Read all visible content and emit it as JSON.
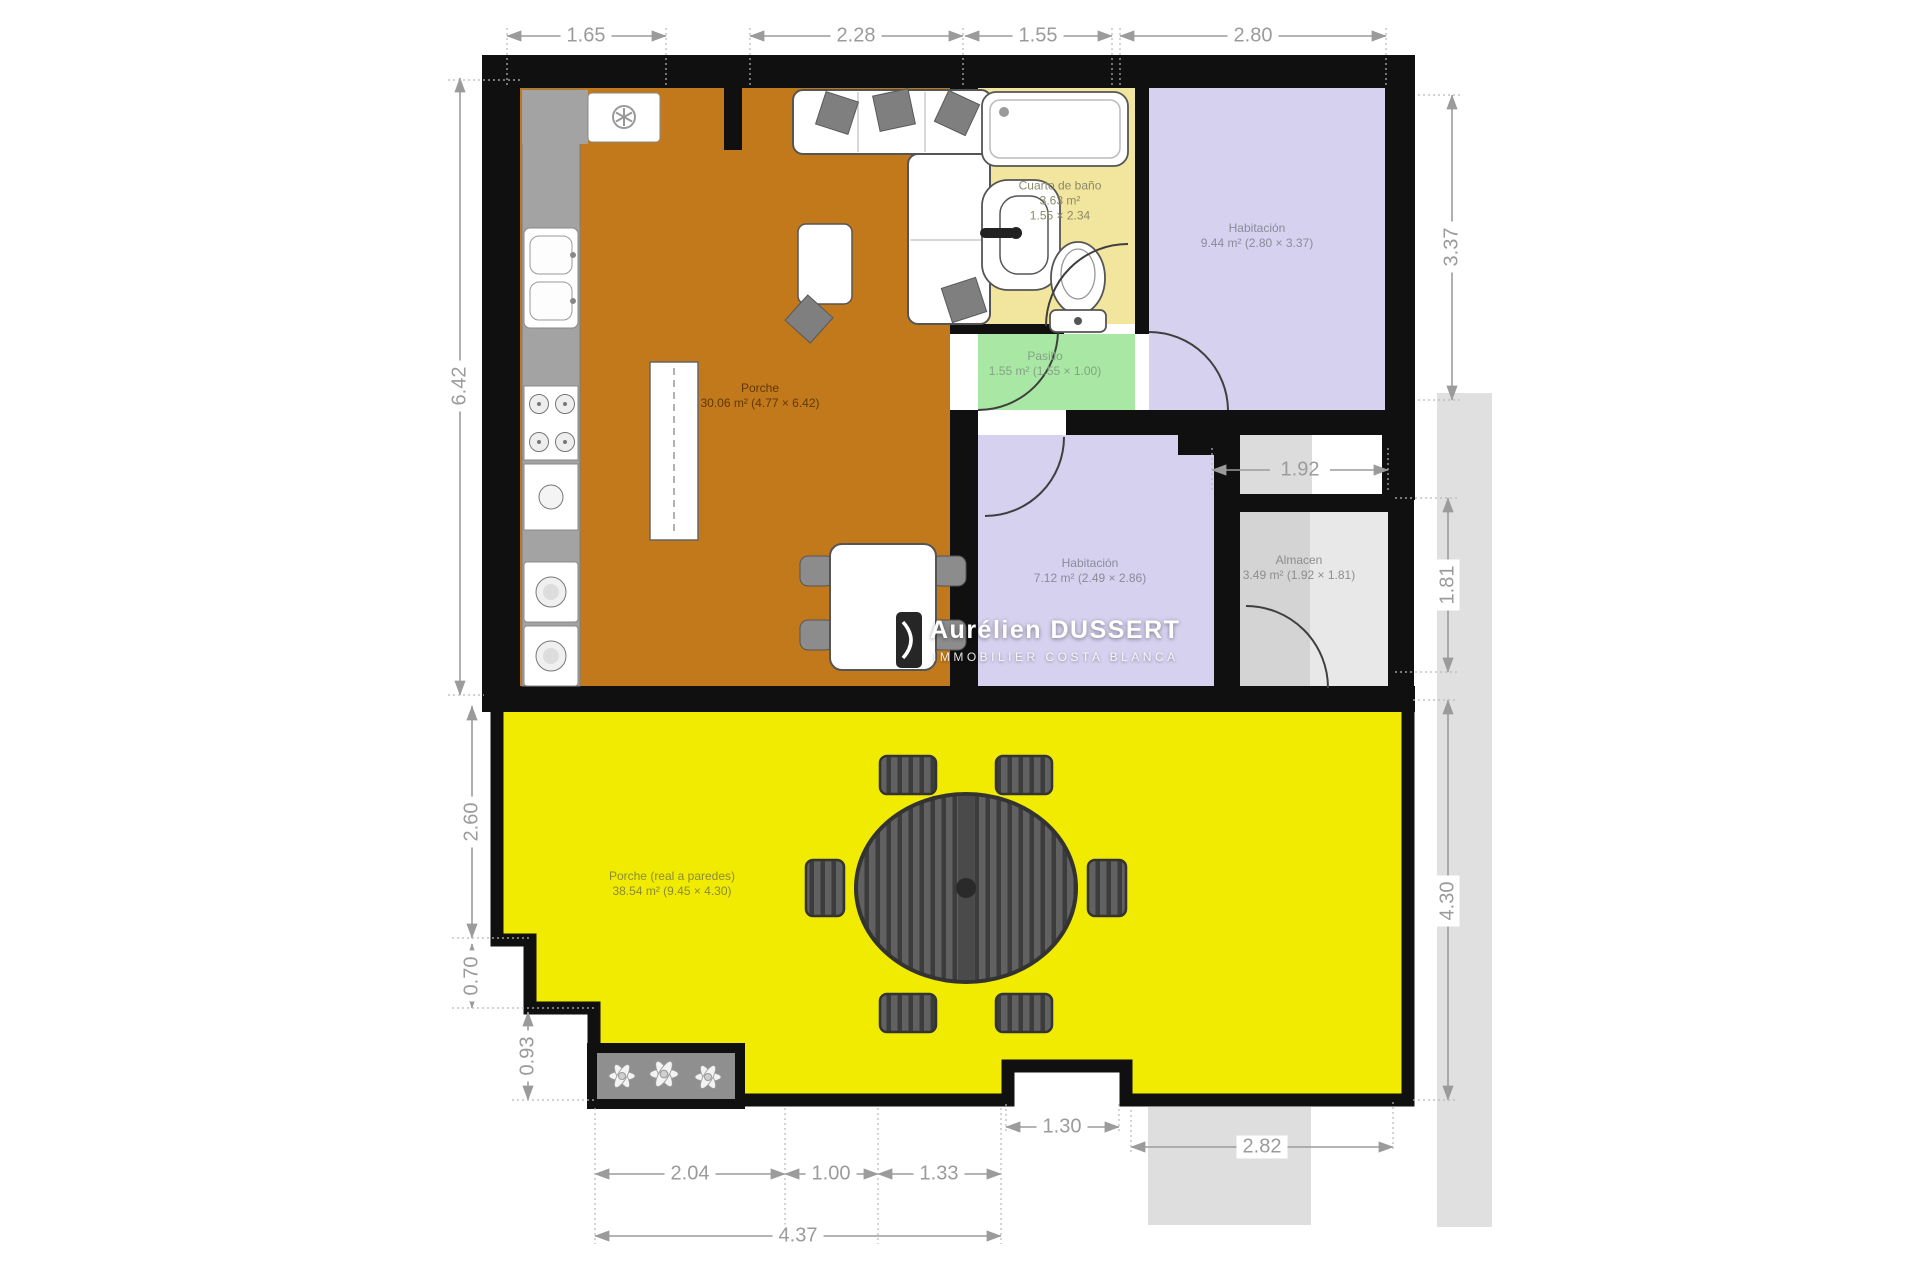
{
  "plan_title": "Floor plan",
  "rooms": {
    "salon": {
      "name": "Porche",
      "detail": "30.06 m² (4.77 × 6.42)"
    },
    "banyo": {
      "name": "Cuarto de baño",
      "area": "3.63 m²",
      "size": "1.55 × 2.34"
    },
    "pasillo": {
      "name": "Pasillo",
      "detail": "1.55 m² (1.55 × 1.00)"
    },
    "habitacion1": {
      "name": "Habitación",
      "detail": "9.44 m² (2.80 × 3.37)"
    },
    "habitacion2": {
      "name": "Habitación",
      "detail": "7.12 m² (2.49 × 2.86)"
    },
    "almacen": {
      "name": "Almacen",
      "detail": "3.49 m² (1.92 × 1.81)"
    },
    "terraza": {
      "name": "Porche (real a paredes)",
      "detail": "38.54 m² (9.45 × 4.30)"
    }
  },
  "dimensions": {
    "top": [
      "1.65",
      "2.28",
      "1.55",
      "2.80"
    ],
    "left": [
      "6.42",
      "2.60",
      "0.70",
      "0.93"
    ],
    "right": [
      "3.37",
      "1.92",
      "1.81",
      "4.30"
    ],
    "bottom": [
      "2.04",
      "1.00",
      "1.33",
      "4.37",
      "1.30",
      "2.82"
    ]
  },
  "watermark": {
    "title": "Aurélien DUSSERT",
    "subtitle": "IMMOBILIER COSTA BLANCA"
  },
  "colors": {
    "wall": "#101010",
    "salon_fill": "#C1791B",
    "bath_fill": "#F2E59E",
    "pasillo_fill": "#A9E7A4",
    "bedroom_fill": "#D5D1EF",
    "almacen_fill": "#D4D4D4",
    "terrace_fill": "#F0EB00",
    "exterior_gray": "#E0E0E0",
    "dimension_gray": "#9B9B9B"
  }
}
